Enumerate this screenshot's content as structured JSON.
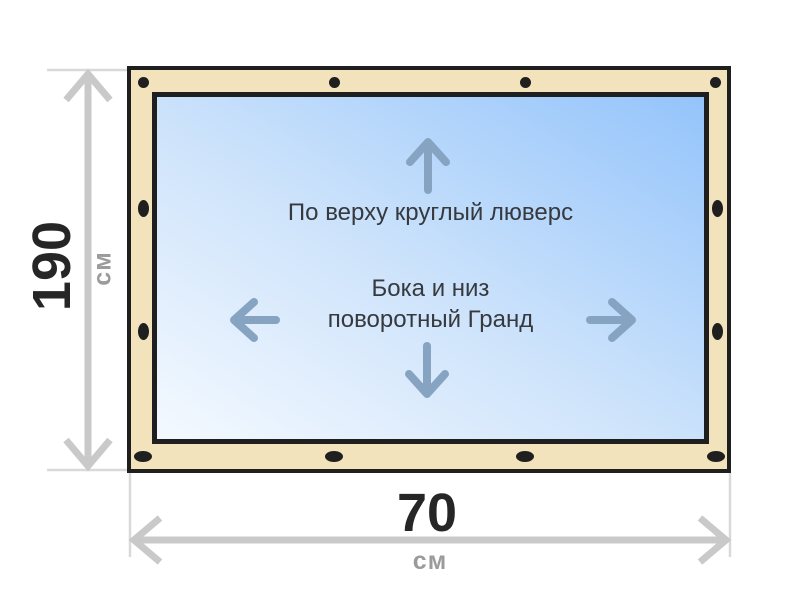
{
  "glass": {
    "top_note": "По верху круглый люверс",
    "mid_note_line1": "Бока и низ",
    "mid_note_line2": "поворотный Гранд"
  },
  "dimensions": {
    "height": {
      "value": "190",
      "unit": "см"
    },
    "width": {
      "value": "70",
      "unit": "см"
    }
  },
  "grommets": {
    "top": {
      "shape": "round",
      "count": 4
    },
    "bottom": {
      "shape": "horizontal-oval",
      "count": 4
    },
    "left": {
      "shape": "vertical-oval",
      "count": 2
    },
    "right": {
      "shape": "vertical-oval",
      "count": 2
    }
  },
  "colors": {
    "frame_fill": "#f2e3bd",
    "outline": "#1f1f1f",
    "glass_light": "#f4f9ff",
    "glass_dark": "#94c4fb",
    "dimension_line": "#c9c9c9",
    "dimension_tick": "#d9d9d9",
    "value_text": "#262626",
    "unit_text": "#9b9b9b",
    "note_text": "#36393d",
    "inner_arrow": "#86a4c2"
  }
}
